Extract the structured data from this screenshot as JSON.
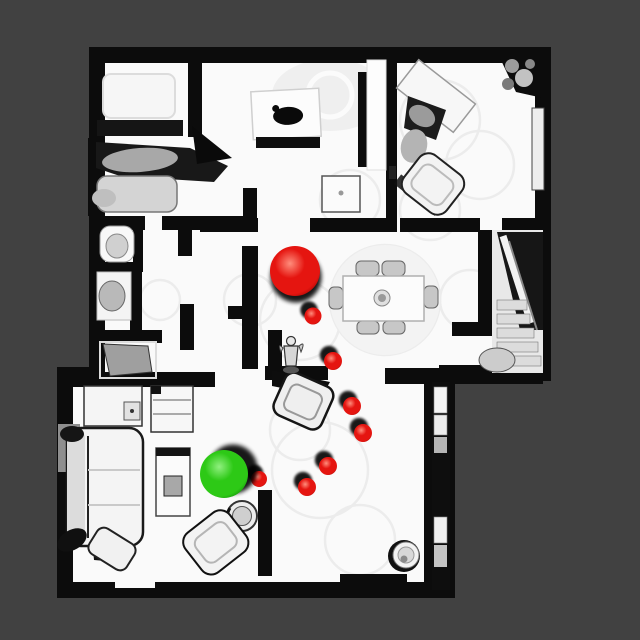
{
  "viewer": {
    "background_color": "#414141",
    "canvas_width": 640,
    "canvas_height": 640
  },
  "scene": {
    "floor_color": "#fafafa",
    "wall_color": "#0c0c0c"
  },
  "markers": {
    "large_green_sphere": {
      "x": 224,
      "y": 474,
      "r": 24,
      "shadow_dx": 9,
      "shadow_dy": -5
    },
    "large_red_sphere": {
      "x": 295,
      "y": 271,
      "r": 25,
      "shadow_dx": 1,
      "shadow_dy": 6
    },
    "small_red_spheres": [
      {
        "x": 313,
        "y": 316,
        "r": 8.5
      },
      {
        "x": 333,
        "y": 361,
        "r": 9
      },
      {
        "x": 352,
        "y": 406,
        "r": 9
      },
      {
        "x": 363,
        "y": 433,
        "r": 9
      },
      {
        "x": 328,
        "y": 466,
        "r": 9
      },
      {
        "x": 307,
        "y": 487,
        "r": 9
      },
      {
        "x": 259,
        "y": 479,
        "r": 8
      }
    ],
    "small_shadow_dx": -4,
    "small_shadow_dy": -6,
    "red_color": {
      "base": "#e51510",
      "highlight": "#ff8d7c",
      "dark": "#8e0200"
    },
    "green_color": {
      "base": "#2dc916",
      "highlight": "#90f07f",
      "dark": "#0a7a05"
    },
    "shadow_color": "#000000"
  },
  "agent": {
    "x": 291,
    "y": 354
  }
}
